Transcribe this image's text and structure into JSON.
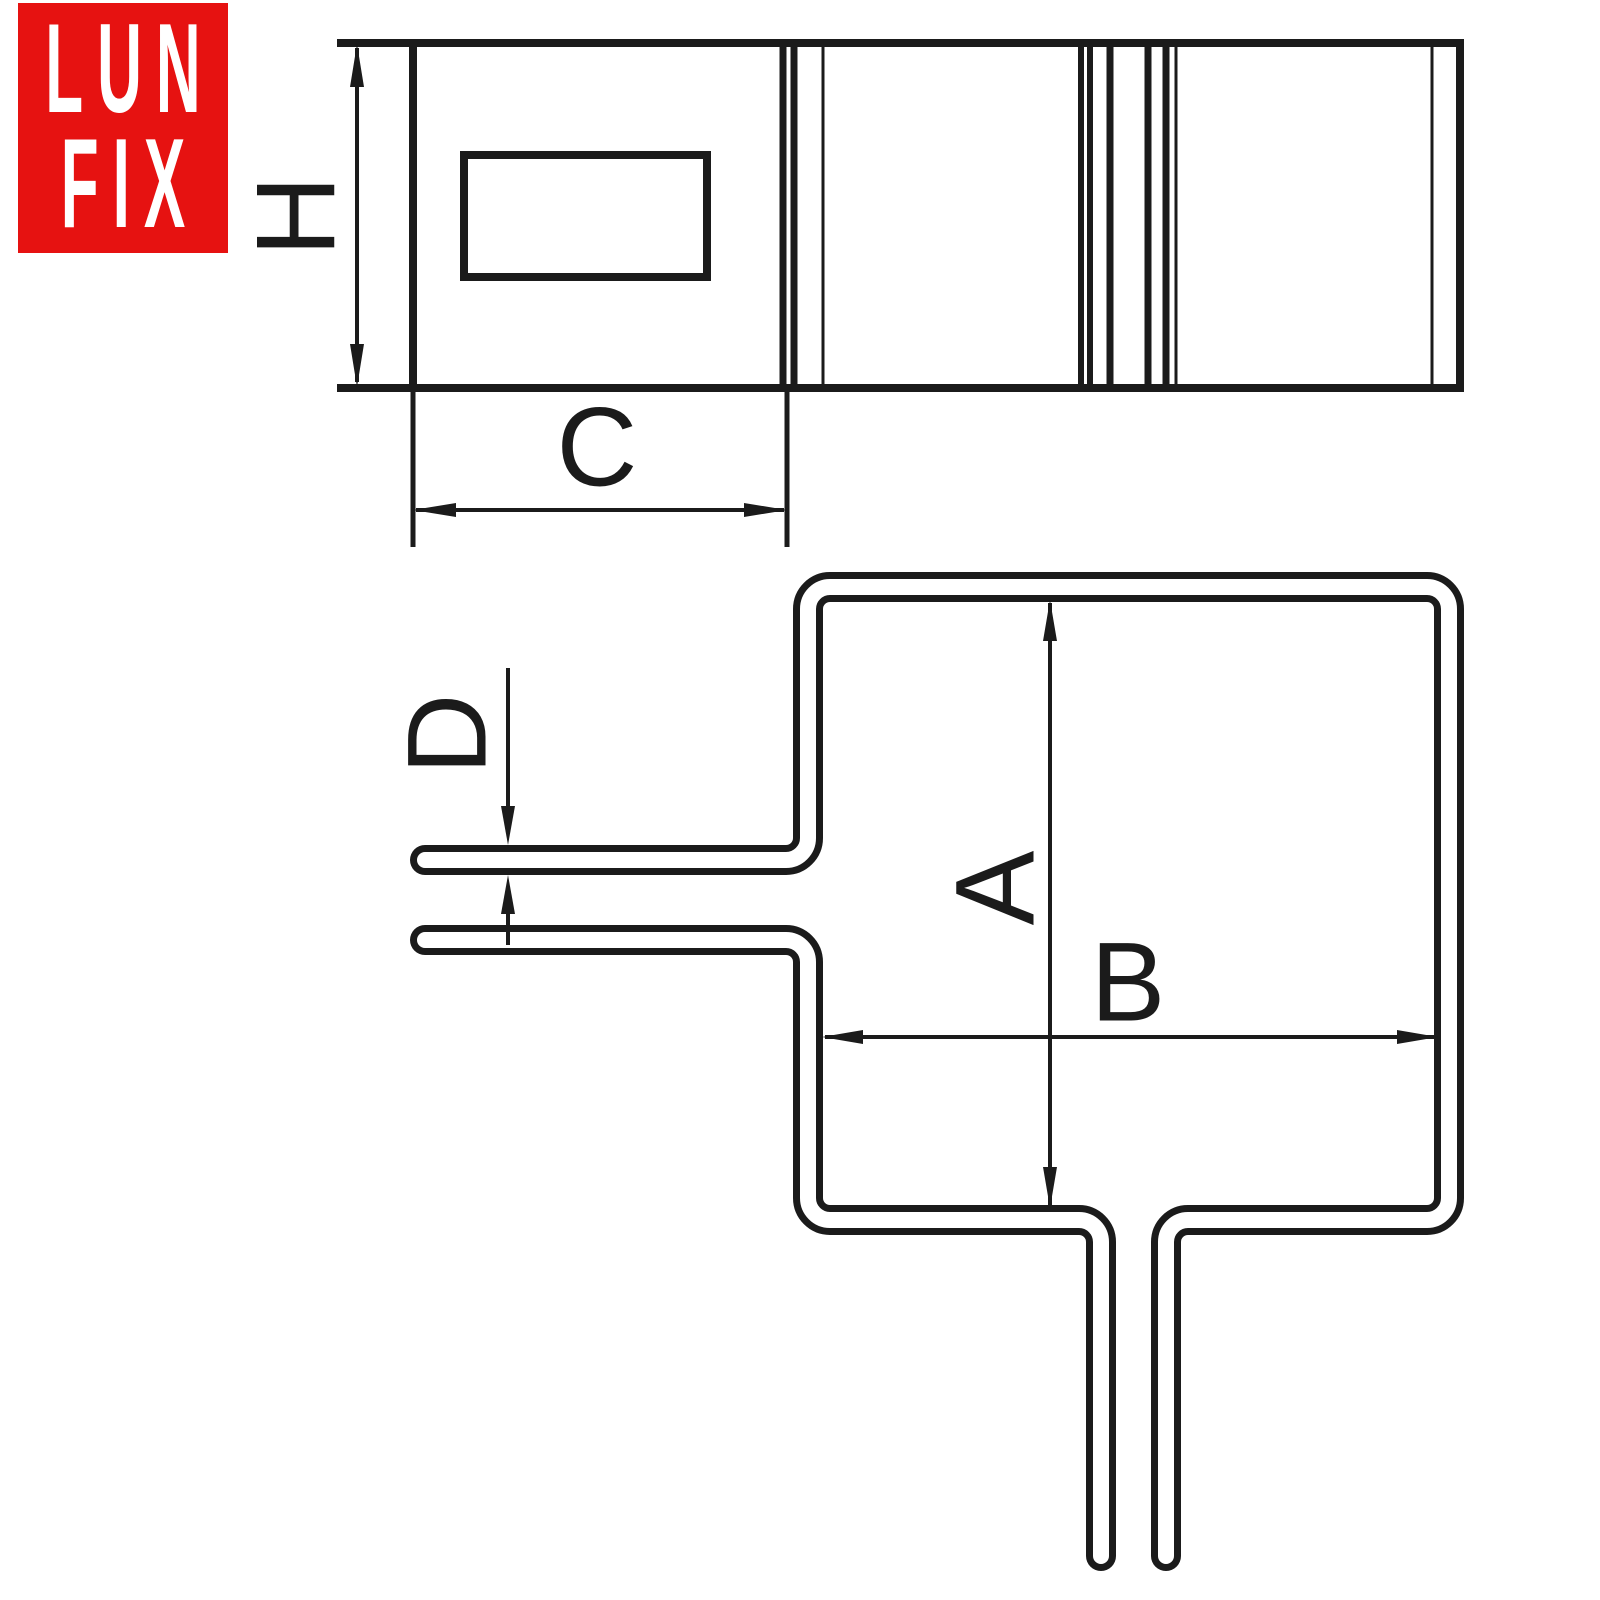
{
  "logo": {
    "line1": "LUN",
    "line2": "FIX",
    "background_color": "#e61211",
    "text_color": "#ffffff"
  },
  "drawing": {
    "description": "Technical dimension drawing of a square pipe clamp: strap side view (top) and bent wire bracket view (bottom)",
    "line_color": "#1b1b1b",
    "background_color": "#ffffff",
    "labels": {
      "strap_height": "H",
      "strap_length": "C",
      "wire_diameter": "D",
      "inner_height": "A",
      "inner_width": "B"
    }
  }
}
